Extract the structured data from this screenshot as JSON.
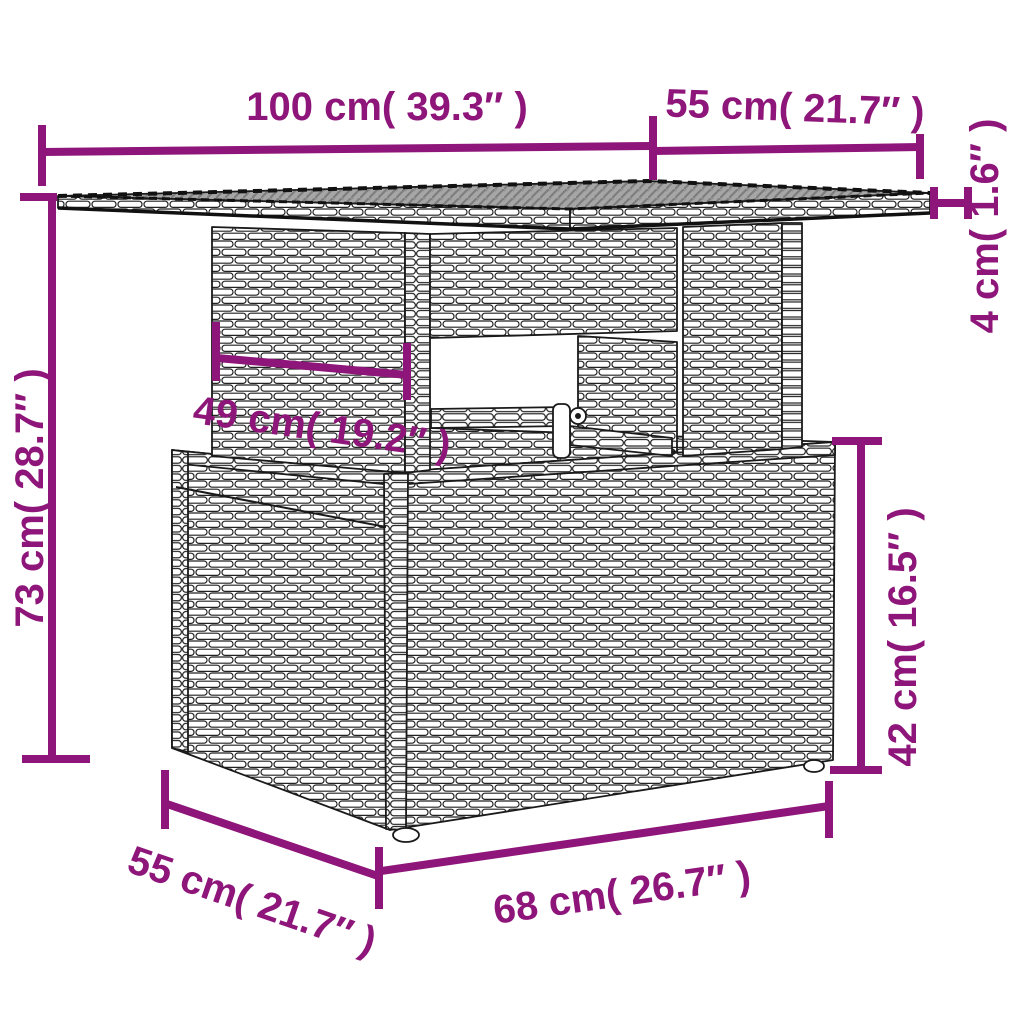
{
  "diagram_type": "furniture-dimension-diagram",
  "colors": {
    "accent": "#8E1579",
    "line_art": "#1a1a1a",
    "glass_top": "#a6a6a6",
    "background": "#ffffff"
  },
  "units": {
    "metric": "cm",
    "imperial": "inches"
  },
  "dims": {
    "top_width": {
      "label": "100 cm( 39.3″ )",
      "cm": 100,
      "inches": 39.3
    },
    "top_depth": {
      "label": "55 cm( 21.7″ )",
      "cm": 55,
      "inches": 21.7
    },
    "top_thickness": {
      "label": "4 cm( 1.6″ )",
      "cm": 4,
      "inches": 1.6
    },
    "total_height": {
      "label": "73 cm( 28.7″ )",
      "cm": 73,
      "inches": 28.7
    },
    "understructure_width": {
      "label": "49 cm( 19.2″ )",
      "cm": 49,
      "inches": 19.2
    },
    "base_height": {
      "label": "42 cm( 16.5″ )",
      "cm": 42,
      "inches": 16.5
    },
    "base_depth": {
      "label": "55 cm( 21.7″ )",
      "cm": 55,
      "inches": 21.7
    },
    "base_width": {
      "label": "68 cm( 26.7″ )",
      "cm": 68,
      "inches": 26.7
    }
  }
}
